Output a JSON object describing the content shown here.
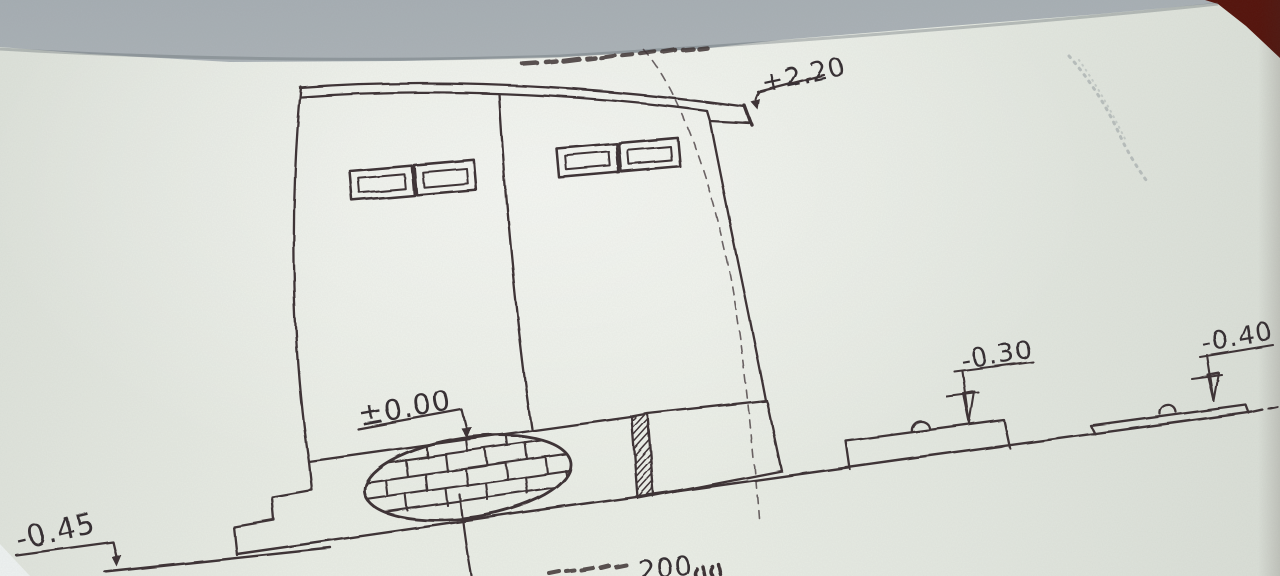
{
  "colors": {
    "paper": "#e9eee6",
    "desk_surface": "#b9c0c3",
    "desk_corner_wood": "#5a160e",
    "ink": "#3c3134",
    "pencil_note": "#90989b"
  },
  "levels": {
    "top": "+2.20",
    "floor": "±0.00",
    "pad_left": "-0.30",
    "pad_right": "-0.40",
    "lower_ground": "-0.45"
  },
  "bottom_note": {
    "value": "200",
    "unit": "มม",
    "full_visible_fragment": "… 200 มม (partially cut off at page edge)"
  }
}
